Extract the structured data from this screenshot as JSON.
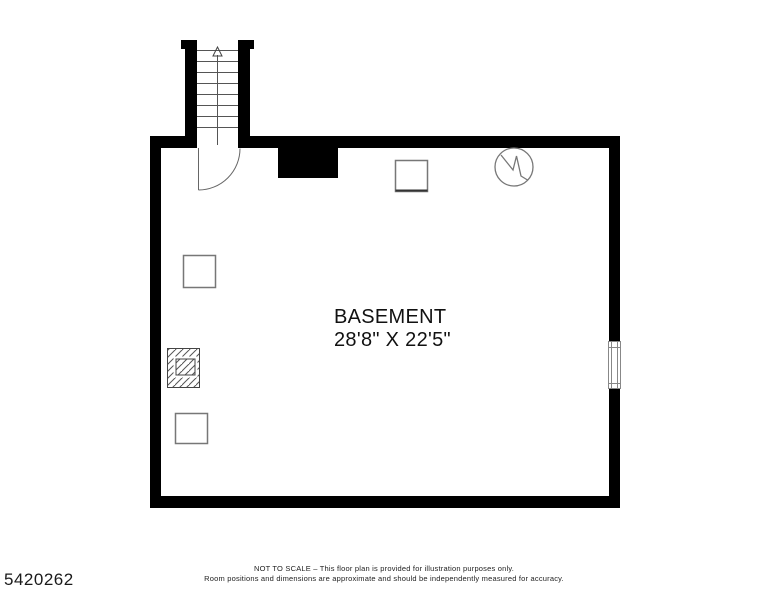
{
  "plan": {
    "room": {
      "name": "BASEMENT",
      "dimensions": "28'8\" X 22'5\""
    },
    "stairs": {
      "direction": "up"
    },
    "symbols": [
      {
        "name": "staircase-up"
      },
      {
        "name": "door-swing"
      },
      {
        "name": "chimney-notch"
      },
      {
        "name": "utility-square-top"
      },
      {
        "name": "water-heater-circle"
      },
      {
        "name": "utility-square-left-upper"
      },
      {
        "name": "hatched-chimney"
      },
      {
        "name": "utility-square-left-lower"
      },
      {
        "name": "window-right-wall"
      }
    ],
    "colors": {
      "wall": "#000000",
      "thin_line": "#666666",
      "background": "#ffffff"
    }
  },
  "footer": {
    "disclaimer_line1": "NOT TO SCALE – This floor plan is provided for illustration purposes only.",
    "disclaimer_line2": "Room positions and dimensions are approximate and should be independently measured for accuracy.",
    "plan_id": "5420262"
  }
}
